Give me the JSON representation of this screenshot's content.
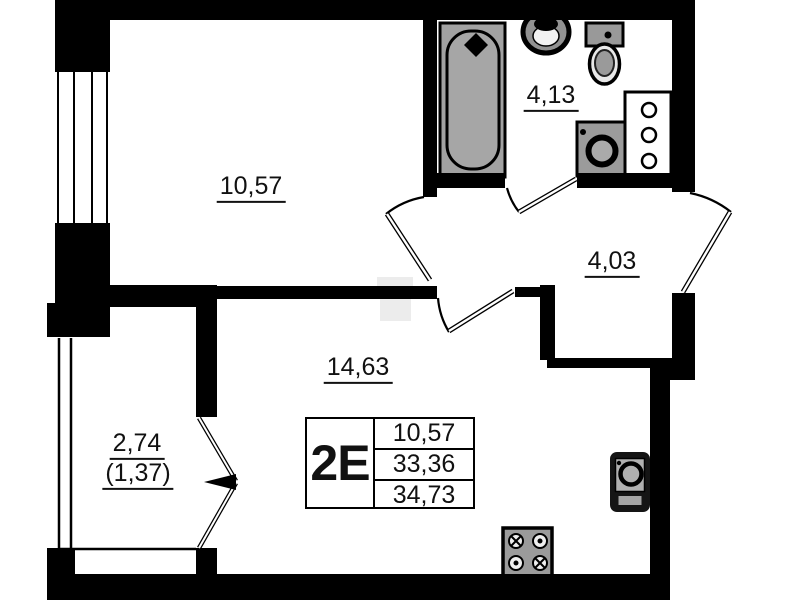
{
  "plan": {
    "unit": "2E",
    "rooms": [
      {
        "id": "room-1",
        "area": "10,57"
      },
      {
        "id": "bathroom",
        "area": "4,13"
      },
      {
        "id": "hallway",
        "area": "4,03"
      },
      {
        "id": "living-room",
        "area": "14,63"
      },
      {
        "id": "balcony",
        "area": "2,74",
        "area_secondary": "(1,37)"
      }
    ],
    "legend": {
      "unit": "2E",
      "values": [
        "10,57",
        "33,36",
        "34,73"
      ]
    },
    "fixtures": [
      "bathtub",
      "wash-basin",
      "toilet",
      "washing-machine",
      "shelf-cabinet",
      "kitchen-sink",
      "stove"
    ],
    "colors": {
      "wall": "#000000",
      "fixture_fill": "#9b9b9b",
      "text": "#111111"
    }
  }
}
